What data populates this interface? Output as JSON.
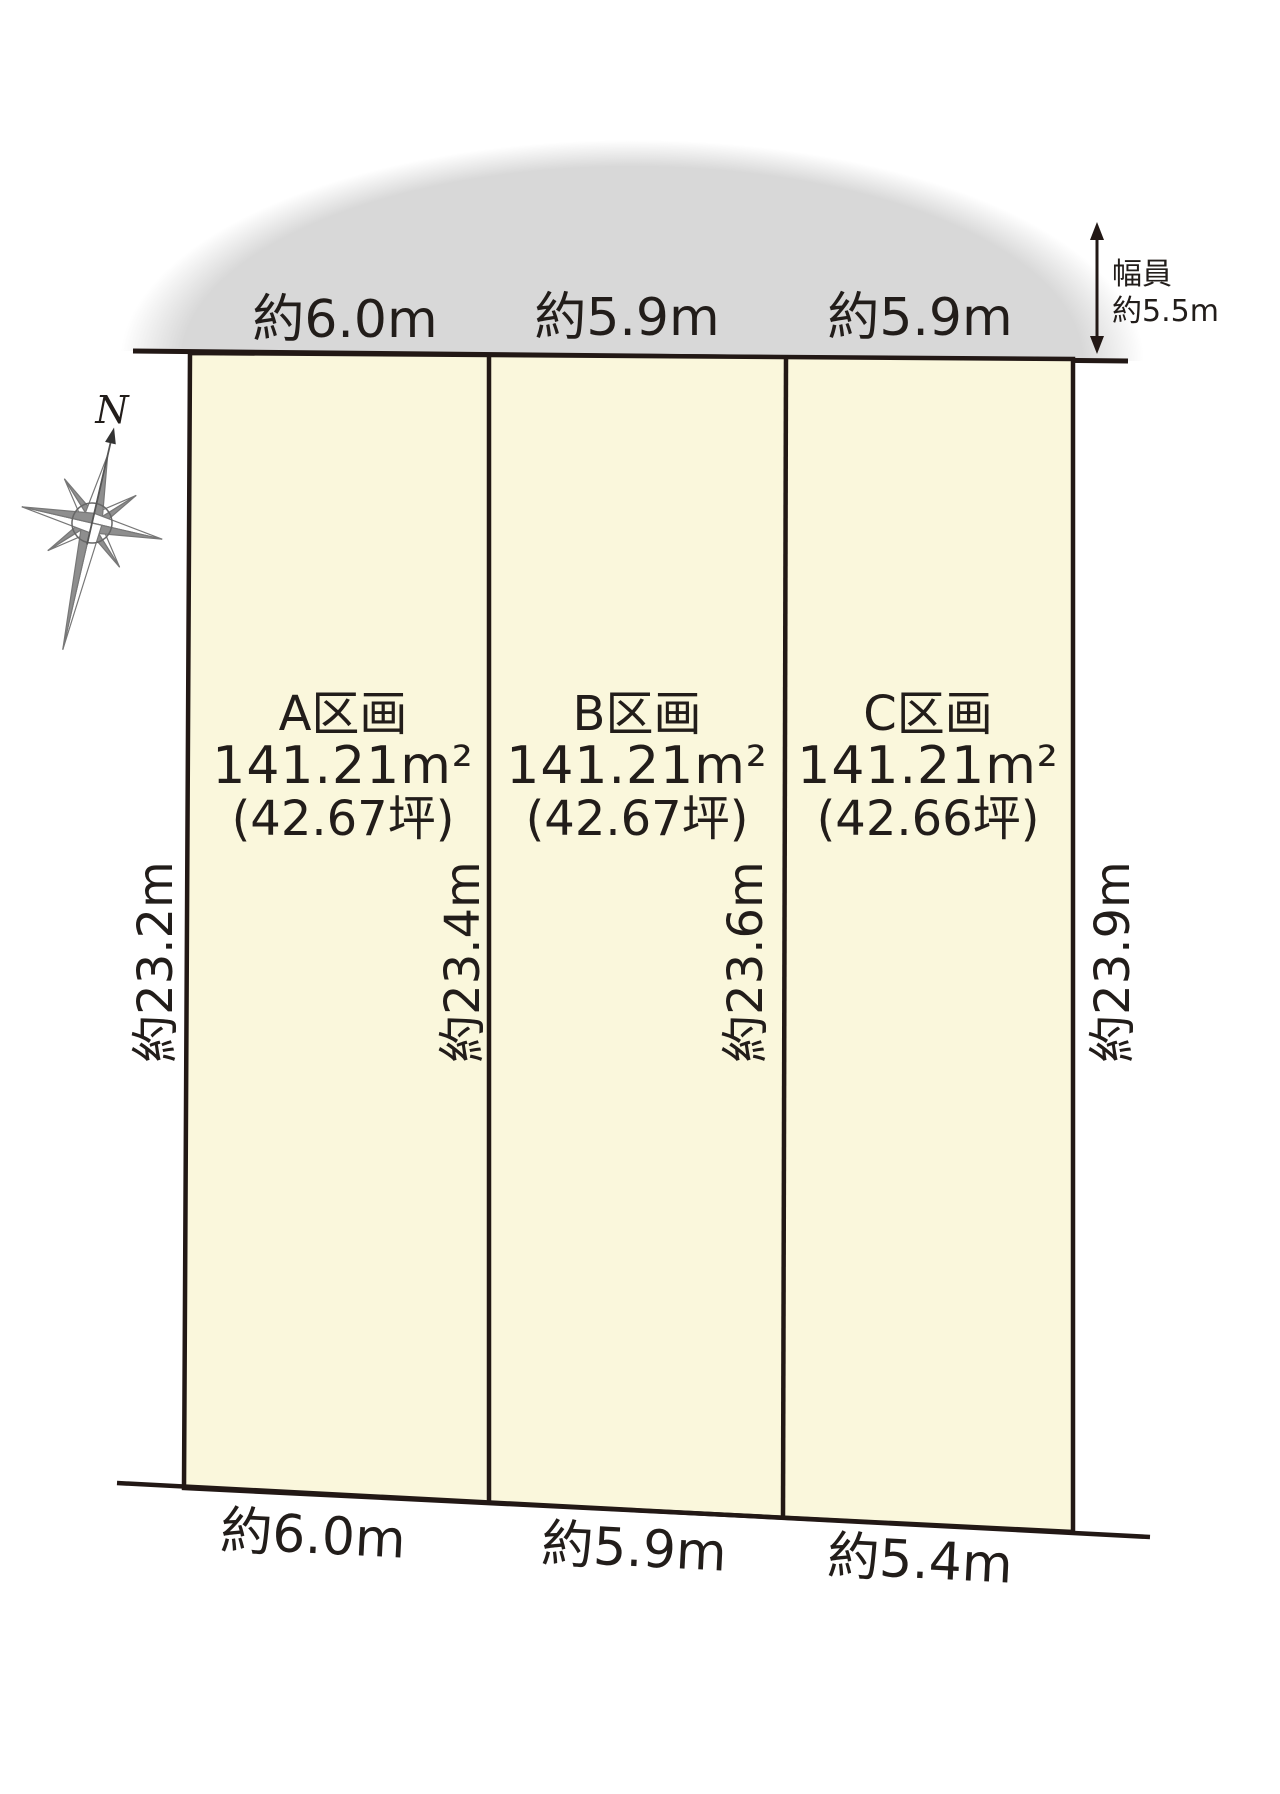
{
  "diagram": {
    "title_hint": "land-parcel-layout",
    "compass": {
      "north_label": "N"
    },
    "road": {
      "width_note_line1": "幅員",
      "width_note_line2": "約5.5m"
    },
    "top_measurements": [
      "約6.0m",
      "約5.9m",
      "約5.9m"
    ],
    "bottom_measurements": [
      "約6.0m",
      "約5.9m",
      "約5.4m"
    ],
    "depth_measurements": [
      "約23.2m",
      "約23.4m",
      "約23.6m",
      "約23.9m"
    ],
    "parcels": [
      {
        "name": "A区画",
        "area_sqm": "141.21m²",
        "area_tsubo": "(42.67坪)"
      },
      {
        "name": "B区画",
        "area_sqm": "141.21m²",
        "area_tsubo": "(42.67坪)"
      },
      {
        "name": "C区画",
        "area_sqm": "141.21m²",
        "area_tsubo": "(42.66坪)"
      }
    ],
    "colors": {
      "parcel_fill": "#faf7dc",
      "road_fill": "#d8d8d8",
      "line": "#221815"
    }
  }
}
